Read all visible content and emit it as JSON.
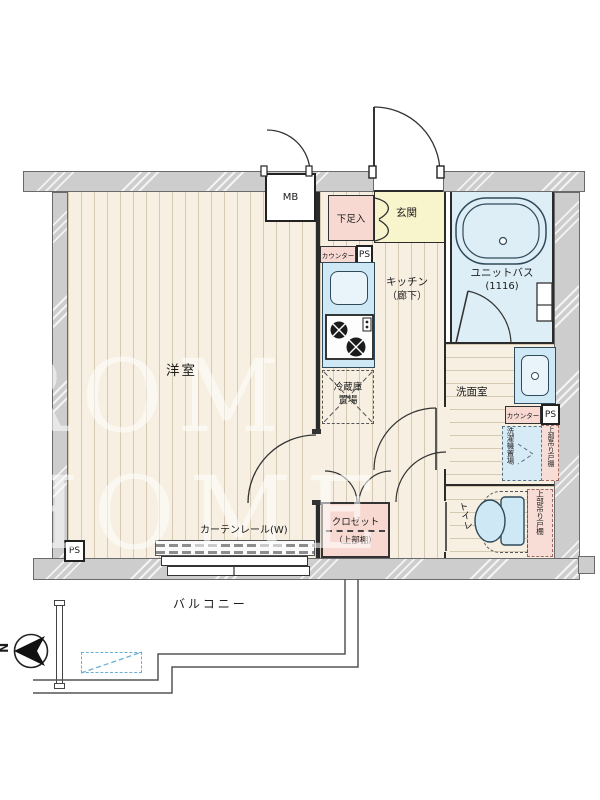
{
  "watermark": "ROM HOME",
  "compass": {
    "north": "N"
  },
  "labels": {
    "main_room": "洋室",
    "balcony": "バルコニー",
    "entrance": "玄関",
    "kitchen1": "キッチン",
    "kitchen2": "（廊下）",
    "bath1": "ユニットバス",
    "bath2": "(1116)",
    "washroom": "洗面室",
    "toilet": "トイレ",
    "meter_box": "MB",
    "shoe_box": "下足入",
    "counter_kitchen": "カウンター",
    "counter_washroom": "カウンター",
    "ps_kitchen": "PS",
    "ps_washroom": "PS",
    "ps_room": "PS",
    "fridge1": "冷蔵庫",
    "fridge2": "置場",
    "washer": "洗濯機置場",
    "cabinet_washroom": "上部吊り戸棚",
    "cabinet_toilet": "上部吊り戸棚",
    "closet1": "クロゼット",
    "closet2": "（上部棚）",
    "curtain_rail": "カーテンレール(W)"
  },
  "colors": {
    "wall": "#cdcdcd",
    "floor": "#f6efe2",
    "stripe": "#d9cebc",
    "entrance_yellow": "#f8f4cc",
    "bath_blue": "#ddeef6",
    "fixture_blue": "#cfe8f5",
    "pink": "#f8d9d2",
    "hatch_dashed_blue": "#6ab0d6"
  }
}
